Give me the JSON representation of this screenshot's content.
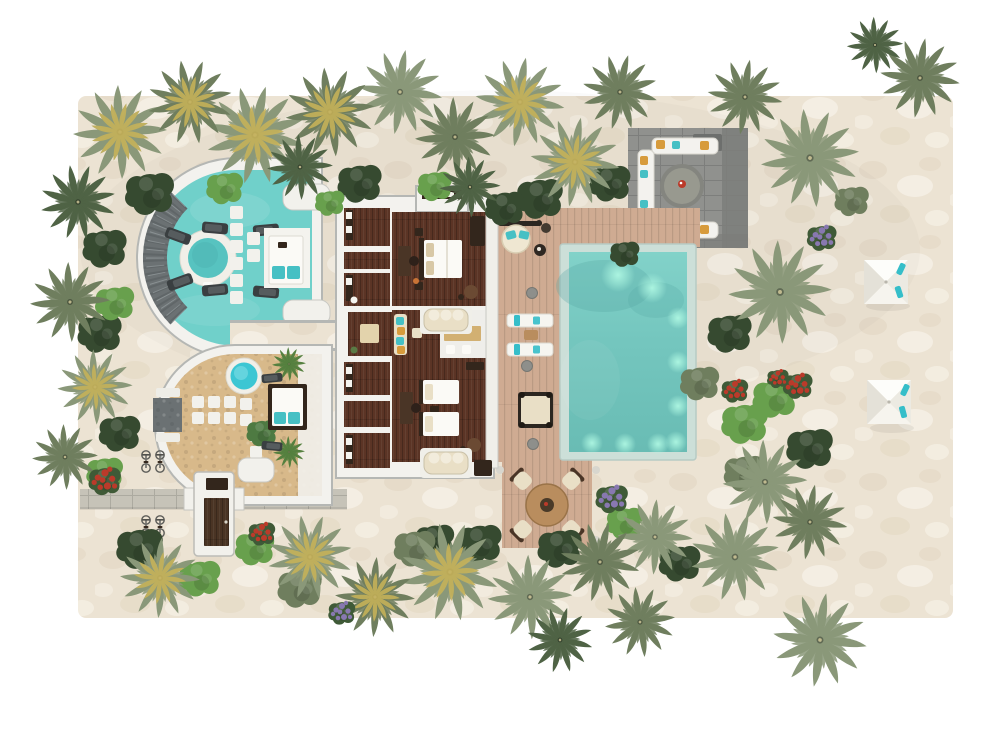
{
  "meta": {
    "title": "Aerial 3D floor-plan rendering of a two-bedroom beach pool villa",
    "view": "top-down"
  },
  "features": {
    "round_suites": 2,
    "wood_floor_bedrooms": 2,
    "main_pool_underwater_lights": 9,
    "pool_sun_loungers": 2,
    "beach_umbrellas": 2,
    "dining_chairs": 4,
    "fire_pit_lounge": 1,
    "bicycles": 4,
    "round_tub": 1,
    "plunge_pool": 1,
    "hanging_chair": 1,
    "daybed": 1
  },
  "palette": {
    "page_bg": "#ffffff",
    "sand_base": "#ece3d3",
    "sand_dark": "#ddd0b8",
    "sand_light": "#f8f3ea",
    "deck_wood": "#cfab92",
    "path_gray": "#c6c3b8",
    "patio_gray": "#90918e",
    "patio_dark": "#7c7e7b",
    "patio_block": "#6d6f6d",
    "pool_tile": "#ccdfd8",
    "pool_water_top": "#82d2c9",
    "pool_water_mid": "#74c6be",
    "pool_water_deep": "#69bcb4",
    "pool_shadow": "#55a7a3",
    "pool_glow": "#aef7e2",
    "suite_floor": "#70d0ca",
    "tub_water": "#57c3c0",
    "plunge_pool": "#3cc6d3",
    "pebble_floor": "#d8b98a",
    "villa_wall": "#f3f2ee",
    "wall_line": "#b5b7b4",
    "wood_floor": "#5b3425",
    "bed_white": "#fbfaf6",
    "pillow_teal": "#46c0c4",
    "pillow_yellow": "#d79b3c",
    "pillow_beige": "#d8c8a6",
    "cushion_cream": "#e9dfc6",
    "furniture_dark": "#33261c",
    "furniture_brown": "#6b4a33",
    "stone_gray": "#6b7173",
    "lounger_white": "#f6f5f0",
    "lounger_teal": "#35bec9",
    "lounger_dark": "#3a3f41",
    "rug_gold": "#d2b072",
    "rug_beige": "#e3d3ac",
    "table_wood": "#b98d5e",
    "veg_sage": "#8a9879",
    "veg_olive": "#6f7e5e",
    "veg_dark": "#4f6345",
    "veg_deep": "#364a30",
    "veg_bright": "#68a04d",
    "veg_yellow": "#c6b25a",
    "flower_red": "#bb3a2a",
    "flower_purple": "#8878b0",
    "umbrella_white": "#f7f5ef"
  }
}
